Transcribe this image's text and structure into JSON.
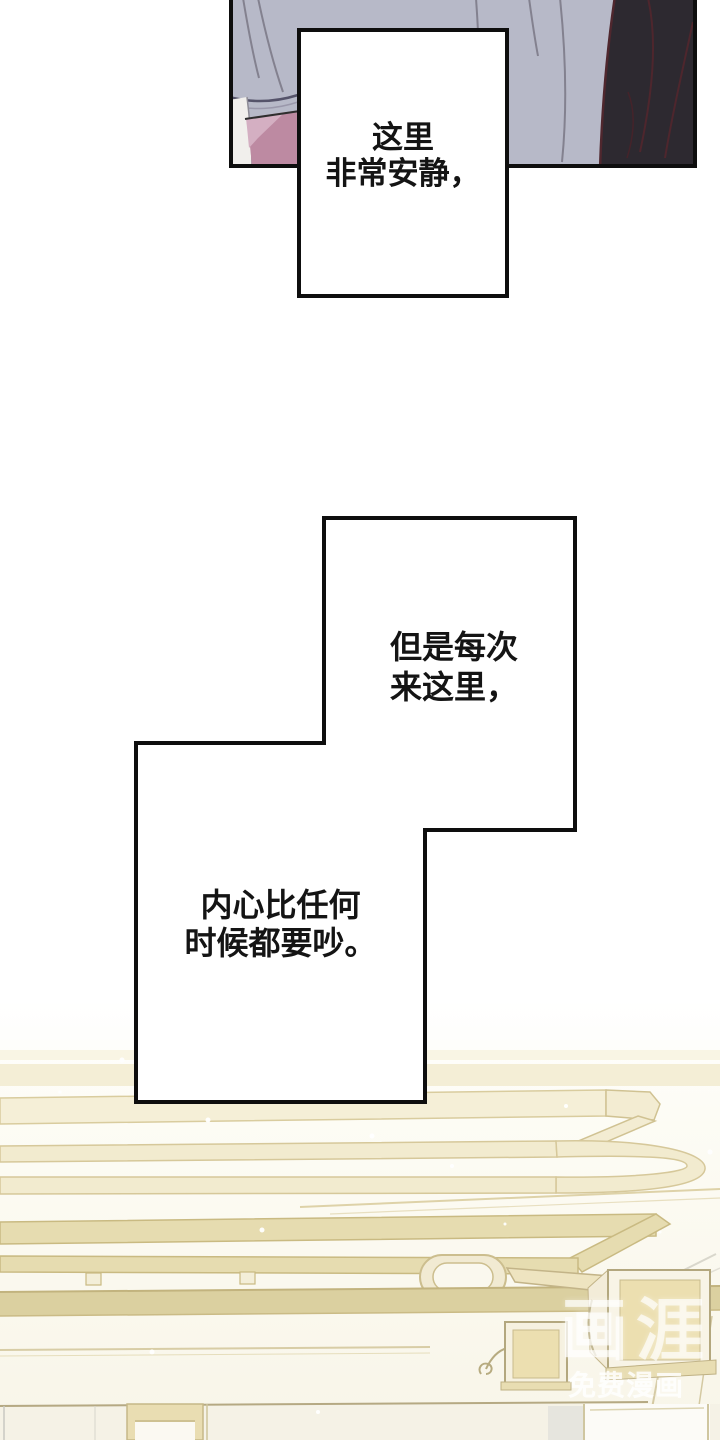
{
  "page": {
    "width": 720,
    "height": 1440,
    "background": "#ffffff"
  },
  "top_panel": {
    "description": "manhwa artwork panel: lavender sleeve, dark garment at right, pink and white clothing at lower left",
    "colors": {
      "sleeve": "#b7b9c8",
      "fold_line": "#83818f",
      "dark_garment": "#2d2930",
      "dark_streak": "#4f272e",
      "pink_garment": "#bd8aa2",
      "pink_highlight": "#d4afc2",
      "white_patch": "#f1efec",
      "outline": "#0e0e0e"
    }
  },
  "captions": [
    {
      "id": "caption-1",
      "lines": [
        "这里",
        "非常安静，"
      ]
    },
    {
      "id": "caption-2",
      "lines": [
        "但是每次",
        "来这里，"
      ]
    },
    {
      "id": "caption-3",
      "lines": [
        "内心比任何",
        "时候都要吵。"
      ]
    }
  ],
  "watermark": {
    "logo": "画涯",
    "subtitle": "免费漫画",
    "color": "#ffffff"
  },
  "bottom_art": {
    "description": "ceiling track-lighting line art in cream tones with two box spotlights and wall panels",
    "colors": {
      "beam_fill": "#f2ebcf",
      "beam_edge": "#d6c89a",
      "stripe": "#e6dcb0",
      "molding": "#dbd0a0",
      "wall": "#f5f2e6",
      "lamp_panel": "#ecdfb0",
      "lamp_frame": "#b3a77e"
    }
  }
}
